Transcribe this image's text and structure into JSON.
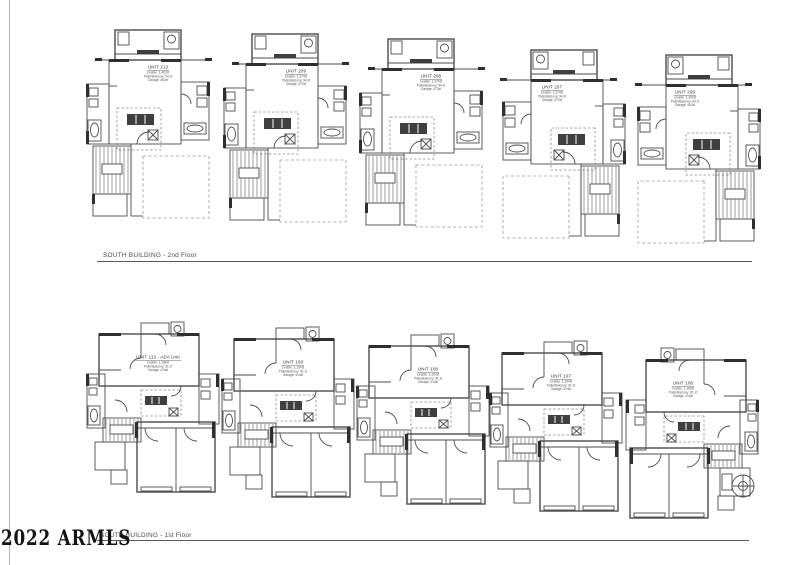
{
  "watermark": "2022 ARMLS",
  "floor2": {
    "caption": "SOUTH BUILDING - 2nd Floor",
    "units": [
      {
        "name": "UNIT 213",
        "line1": "Livable: 1,402sf",
        "line2": "Patio/Balcony: 94 sf",
        "line3": "Garage: 462sf"
      },
      {
        "name": "UNIT 209",
        "line1": "Livable: 1,374sf",
        "line2": "Patio/Balcony: 94 sf",
        "line3": "Garage: 472sf"
      },
      {
        "name": "UNIT 208",
        "line1": "Livable: 1,374sf",
        "line2": "Patio/Balcony: 94 sf",
        "line3": "Garage: 472sf"
      },
      {
        "name": "UNIT 207",
        "line1": "Livable: 1,374sf",
        "line2": "Patio/Balcony: 94 sf",
        "line3": "Garage: 472sf"
      },
      {
        "name": "UNIT 206",
        "line1": "Livable: 1,390sf",
        "line2": "Patio/Balcony: 94 sf",
        "line3": "Garage: 462sf"
      }
    ]
  },
  "floor1": {
    "caption": "SOUTH BUILDING - 1st Floor",
    "units": [
      {
        "name": "UNIT 113 - ADA Unit",
        "line1": "Livable: 1,188sf",
        "line2": "Patio/Balcony: 81 sf",
        "line3": "Garage: 414sf"
      },
      {
        "name": "UNIT 109",
        "line1": "Livable: 1,154sf",
        "line2": "Patio/Balcony: 81 sf",
        "line3": "Garage: 414sf"
      },
      {
        "name": "UNIT 108",
        "line1": "Livable: 1,154sf",
        "line2": "Patio/Balcony: 81 sf",
        "line3": "Garage: 414sf"
      },
      {
        "name": "UNIT 107",
        "line1": "Livable: 1,154sf",
        "line2": "Patio/Balcony: 81 sf",
        "line3": "Garage: 414sf"
      },
      {
        "name": "UNIT 106",
        "line1": "Livable: 1,166sf",
        "line2": "Patio/Balcony: 81 sf",
        "line3": "Garage: 414sf"
      }
    ]
  }
}
